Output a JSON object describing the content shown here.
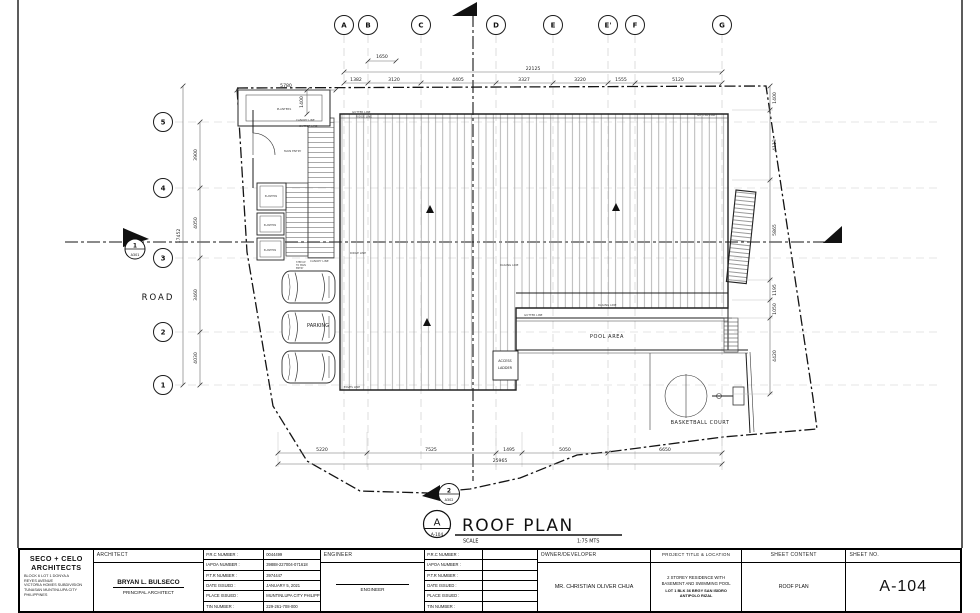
{
  "drawing_title": {
    "bubble_letter": "A",
    "bubble_sheet": "A-104",
    "title": "ROOF PLAN",
    "scale_label": "SCALE",
    "scale_value": "1:75 MTS"
  },
  "grid": {
    "top_labels": [
      "A",
      "B",
      "C",
      "D",
      "E",
      "E'",
      "F",
      "G"
    ],
    "left_labels": [
      "5",
      "4",
      "3",
      "2",
      "1"
    ]
  },
  "dimensions": {
    "top_overall": "22125",
    "top_segments": [
      "1382",
      "3120",
      "4405",
      "3327",
      "3220",
      "1555",
      "5120"
    ],
    "top_small": "1650",
    "top_left": "5780",
    "canopy_depth": "1400",
    "left_overall": "17452",
    "left_segments": [
      "3900",
      "4050",
      "3460",
      "4030"
    ],
    "right_segments": [
      "1400",
      "4113",
      "5865",
      "1195",
      "1050",
      "4420"
    ],
    "bottom_segments": [
      "5220",
      "7525",
      "1495",
      "5050",
      "6650"
    ],
    "bottom_overall": "25965"
  },
  "labels": {
    "road": "ROAD",
    "parking": "PARKING",
    "pool_area": "POOL AREA",
    "access_ladder_1": "ACCESS",
    "access_ladder_2": "LADDER",
    "basketball_court": "BASKETBALL COURT",
    "planters": "PLANTERS",
    "main_entry": "MAIN ENTRY",
    "gutter_line": "GUTTER LINE",
    "ridge_line": "RIDGE LINE",
    "railing_line": "RAILING LINE",
    "canopy_line": "CANOPY LINE",
    "eaves_line": "EAVES LINE",
    "step_up_1": "STEP-UP",
    "step_up_2": "TO MAIN",
    "step_up_3": "ENTRY"
  },
  "section_markers": {
    "left": {
      "number": "1",
      "sheet": "A301"
    },
    "bottom": {
      "number": "2",
      "sheet": "A302"
    }
  },
  "title_block": {
    "firm": {
      "name_line1": "SECO + CELO",
      "name_line2": "ARCHITECTS",
      "address": {
        "l1": "BLOCK 6 LOT 1 DONYA A",
        "l2": "REYES AVENUE",
        "l3": "VICTORIA HOMES SUBDIVISION",
        "l4": "TUNASAN MUNTINLUPA CITY",
        "l5": "PHILIPPINES"
      }
    },
    "architect": {
      "header": "ARCHITECT",
      "name": "BRYAN L. BULSECO",
      "role": "PRINCIPAL ARCHITECT",
      "fields": [
        {
          "label": "P.R.C NUMBER :",
          "value": "0044499"
        },
        {
          "label": "IAPOA NUMBER :",
          "value": "39888-227004-071618"
        },
        {
          "label": "P.T.R NUMBER :",
          "value": "3974447"
        },
        {
          "label": "DATE ISSUED :",
          "value": "JANUARY 5, 2021"
        },
        {
          "label": "PLACE ISSUED :",
          "value": "MUNTINLUPA CITY PHILIPPINES"
        },
        {
          "label": "TIN NUMBER :",
          "value": "229-261-708-000"
        }
      ]
    },
    "engineer": {
      "header": "ENGINEER",
      "role": "ENGINEER",
      "fields": [
        {
          "label": "P.R.C NUMBER :",
          "value": ""
        },
        {
          "label": "IAPOA NUMBER :",
          "value": ""
        },
        {
          "label": "P.T.R NUMBER :",
          "value": ""
        },
        {
          "label": "DATE ISSUED :",
          "value": ""
        },
        {
          "label": "PLACE ISSUED :",
          "value": ""
        },
        {
          "label": "TIN NUMBER :",
          "value": ""
        }
      ]
    },
    "owner": {
      "header": "OWNER/DEVELOPER",
      "name": "MR. CHRISTIAN OLIVER CHUA"
    },
    "project": {
      "header": "PROJECT TITLE & LOCATION",
      "line1": "2 STOREY RESIDENCE WITH",
      "line2": "BASEMENT AND SWIMMING POOL",
      "line3": "LOT 1 BLK 36 BRGY SAN ISIDRO",
      "line4": "ANTIPOLO RIZAL"
    },
    "sheet_content": {
      "header": "SHEET CONTENT",
      "value": "ROOF PLAN"
    },
    "sheet_no": {
      "header": "SHEET NO.",
      "value": "A-104"
    }
  }
}
